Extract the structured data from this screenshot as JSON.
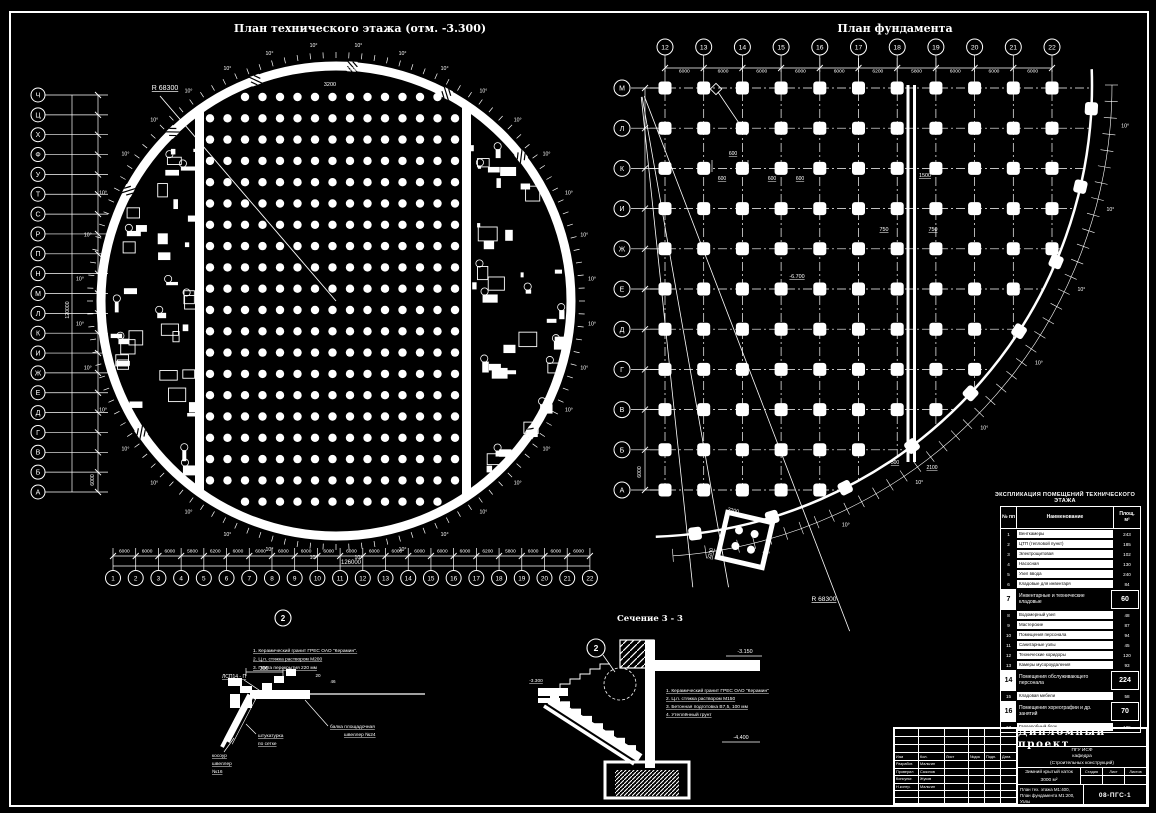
{
  "colors": {
    "bg": "#000000",
    "fg": "#ffffff",
    "accent_blue": "#2228dd"
  },
  "left_plan": {
    "title": "План технического этажа (отм. -3.300)",
    "radius_label": "R 68300",
    "angle_label": "10°",
    "top_dim": "3200",
    "row_axes": [
      "Ч",
      "Ц",
      "Х",
      "Ф",
      "У",
      "Т",
      "С",
      "Р",
      "П",
      "Н",
      "М",
      "Л",
      "К",
      "И",
      "Ж",
      "Е",
      "Д",
      "Г",
      "В",
      "Б",
      "А"
    ],
    "row_dim": "6000",
    "row_total": "120000",
    "col_axes": [
      "1",
      "2",
      "3",
      "4",
      "5",
      "6",
      "7",
      "8",
      "9",
      "10",
      "11",
      "12",
      "13",
      "14",
      "15",
      "16",
      "17",
      "18",
      "19",
      "20",
      "21",
      "22"
    ],
    "col_dims": [
      "6000",
      "6000",
      "6000",
      "5800",
      "6200",
      "6000",
      "6000",
      "6000",
      "6000",
      "6000",
      "6000",
      "6000",
      "6000",
      "6000",
      "6000",
      "6000",
      "6200",
      "5800",
      "6000",
      "6000",
      "6000"
    ],
    "col_total": "126000",
    "detail_callout": "2"
  },
  "right_plan": {
    "title": "План фундамента",
    "col_axes": [
      "12",
      "13",
      "14",
      "15",
      "16",
      "17",
      "18",
      "19",
      "20",
      "21",
      "22"
    ],
    "col_dims": [
      "6000",
      "6000",
      "6000",
      "6000",
      "6000",
      "6200",
      "5800",
      "6000",
      "6000",
      "6000"
    ],
    "row_axes": [
      "М",
      "Л",
      "К",
      "И",
      "Ж",
      "Е",
      "Д",
      "Г",
      "В",
      "Б",
      "А"
    ],
    "row_dim": "6000",
    "radius_label": "R 68300",
    "angle_label": "10°",
    "joint_dim": "1500",
    "joint_half_left": "750",
    "joint_half_right": "750",
    "pier_offset_dim": "600",
    "elevation": "-6.700",
    "edge_dim_a": "500",
    "edge_dim_b": "2100",
    "detail_dim": "3200"
  },
  "section": {
    "title": "Сечение 3 - 3",
    "callout": "2",
    "elev_top": "-3.150",
    "elev_left": "-3.300",
    "elev_bottom": "-4.400",
    "notes": [
      "1. Керамический гранит ГРЕС ОАО \"Керамин\"",
      "2. Ц.п. стяжка раствором М150",
      "3. Бетонная подготовка В7,5, 100 мм",
      "4. Утеплённый грунт"
    ]
  },
  "node_detail": {
    "notes": [
      "1. Керамический гранит ГРЕС ОАО \"Керамин\".",
      "2. Ц.п. стяжка раствором М200",
      "3. Плита перекрытия 220 мм"
    ],
    "label_panel": "ЛСП14 - П",
    "label_beam_1": "балка площадочная",
    "label_beam_2": "швеллер №24",
    "label_plaster_1": "штукатурка",
    "label_plaster_2": "по сетке",
    "label_stringer_1": "косоур",
    "label_stringer_2": "швеллер",
    "label_stringer_3": "№16",
    "dim_a": "300",
    "dim_b": "20",
    "dim_c": "46"
  },
  "spec_table": {
    "title": "ЭКСПЛИКАЦИЯ ПОМЕЩЕНИЙ ТЕХНИЧЕСКОГО ЭТАЖА",
    "col_num": "№ пп",
    "col_name": "Наименование",
    "col_area_1": "Площ.",
    "col_area_2": "м²",
    "rows": [
      {
        "n": "1",
        "name": "Венткамеры",
        "area": "243",
        "hl": false
      },
      {
        "n": "2",
        "name": "ЦТП (тепловой пункт)",
        "area": "185",
        "hl": false
      },
      {
        "n": "3",
        "name": "Электрощитовая",
        "area": "102",
        "hl": false
      },
      {
        "n": "4",
        "name": "Насосная",
        "area": "130",
        "hl": false
      },
      {
        "n": "5",
        "name": "Узел ввода",
        "area": "240",
        "hl": false
      },
      {
        "n": "6",
        "name": "Кладовые для инвентаря",
        "area": "84",
        "hl": false
      },
      {
        "n": "7",
        "name": "Инвентарные и технические кладовые",
        "area": "60",
        "hl": true
      },
      {
        "n": "8",
        "name": "Водомерный узел",
        "area": "48",
        "hl": false
      },
      {
        "n": "9",
        "name": "Мастерские",
        "area": "87",
        "hl": false
      },
      {
        "n": "10",
        "name": "Помещения персонала",
        "area": "94",
        "hl": false
      },
      {
        "n": "11",
        "name": "Санитарные узлы",
        "area": "45",
        "hl": false
      },
      {
        "n": "12",
        "name": "Технические коридоры",
        "area": "120",
        "hl": false
      },
      {
        "n": "13",
        "name": "Камеры мусороудаления",
        "area": "93",
        "hl": false
      },
      {
        "n": "14",
        "name": "Помещения обслуживающего персонала",
        "area": "224",
        "hl": true
      },
      {
        "n": "15",
        "name": "Кладовая мебели",
        "area": "58",
        "hl": false
      },
      {
        "n": "16",
        "name": "Помещения хореографии и др. занятий",
        "area": "70",
        "hl": true
      },
      {
        "n": "17",
        "name": "Гардеробный блок",
        "area": "105",
        "hl": false
      }
    ]
  },
  "title_block": {
    "project": "Дипломный проект",
    "org_lines": [
      "ПГУ ИСФ",
      "кафедра",
      "(Строительных конструкций)"
    ],
    "object_lines": [
      "Зимний крытый каток",
      "3000 м²"
    ],
    "sheet_lines": [
      "План тех. этажа М1:400,",
      "План фундамента М1:200, Узлы"
    ],
    "doc_code": "08-ПГС-1",
    "stage_cols": [
      "Стадия",
      "Лист",
      "Листов"
    ],
    "sign_cols": [
      "Изм",
      "Кол.",
      "Лист",
      "№док",
      "Подп.",
      "Дата"
    ],
    "sign_rows": [
      [
        "Разработ.",
        "Мальгин"
      ],
      [
        "Проверил",
        "Сазонов"
      ],
      [
        "Консульт.",
        "Жуков"
      ],
      [
        "Н.контр.",
        "Мальгин"
      ]
    ]
  }
}
